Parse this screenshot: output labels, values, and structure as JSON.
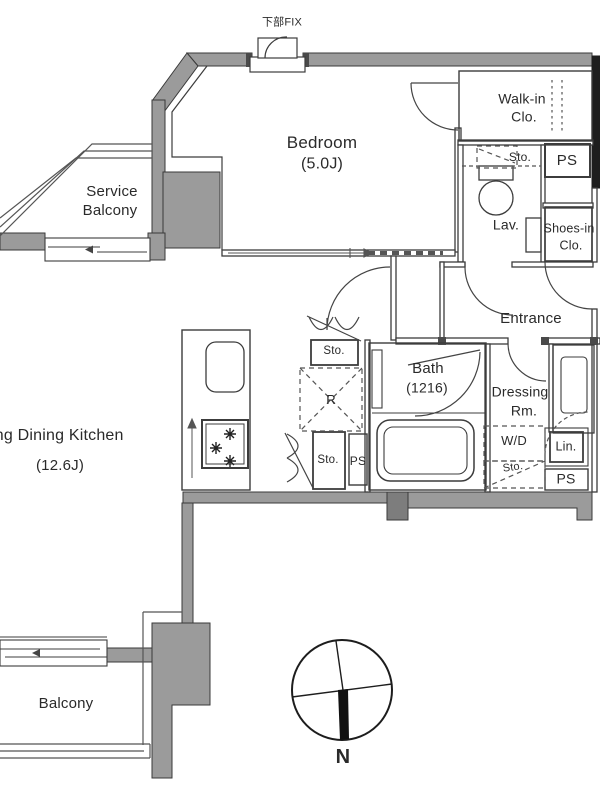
{
  "fix_window_label": "下部FIX",
  "bedroom": {
    "name": "Bedroom",
    "size": "(5.0J)"
  },
  "service_balcony": {
    "line1": "Service",
    "line2": "Balcony"
  },
  "walkin_closet": {
    "line1": "Walk-in",
    "line2": "Clo."
  },
  "lavatory": {
    "label": "Lav.",
    "storage": "Sto."
  },
  "pipe_spaces": {
    "top": "PS",
    "kitchen": "PS",
    "bottom": "PS"
  },
  "shoes_closet": {
    "line1": "Shoes-in",
    "line2": "Clo."
  },
  "entrance": {
    "label": "Entrance"
  },
  "hall_storage": "Sto.",
  "bath": {
    "name": "Bath",
    "size": "(1216)"
  },
  "dressing_room": {
    "line1": "Dressing",
    "line2": "Rm."
  },
  "refrigerator": "R",
  "ldk": {
    "name": "Living Dining Kitchen",
    "size": "(12.6J)"
  },
  "kitchen_storage": "Sto.",
  "washer_dryer": {
    "label": "W/D",
    "storage": "Sto."
  },
  "linen": "Lin.",
  "balcony": "Balcony",
  "compass": {
    "north": "N"
  },
  "colors": {
    "wall_gray": "#9b9b9b",
    "wall_dark": "#1e1e1e",
    "line": "#3c3c3c",
    "text": "#2a2a2a"
  }
}
